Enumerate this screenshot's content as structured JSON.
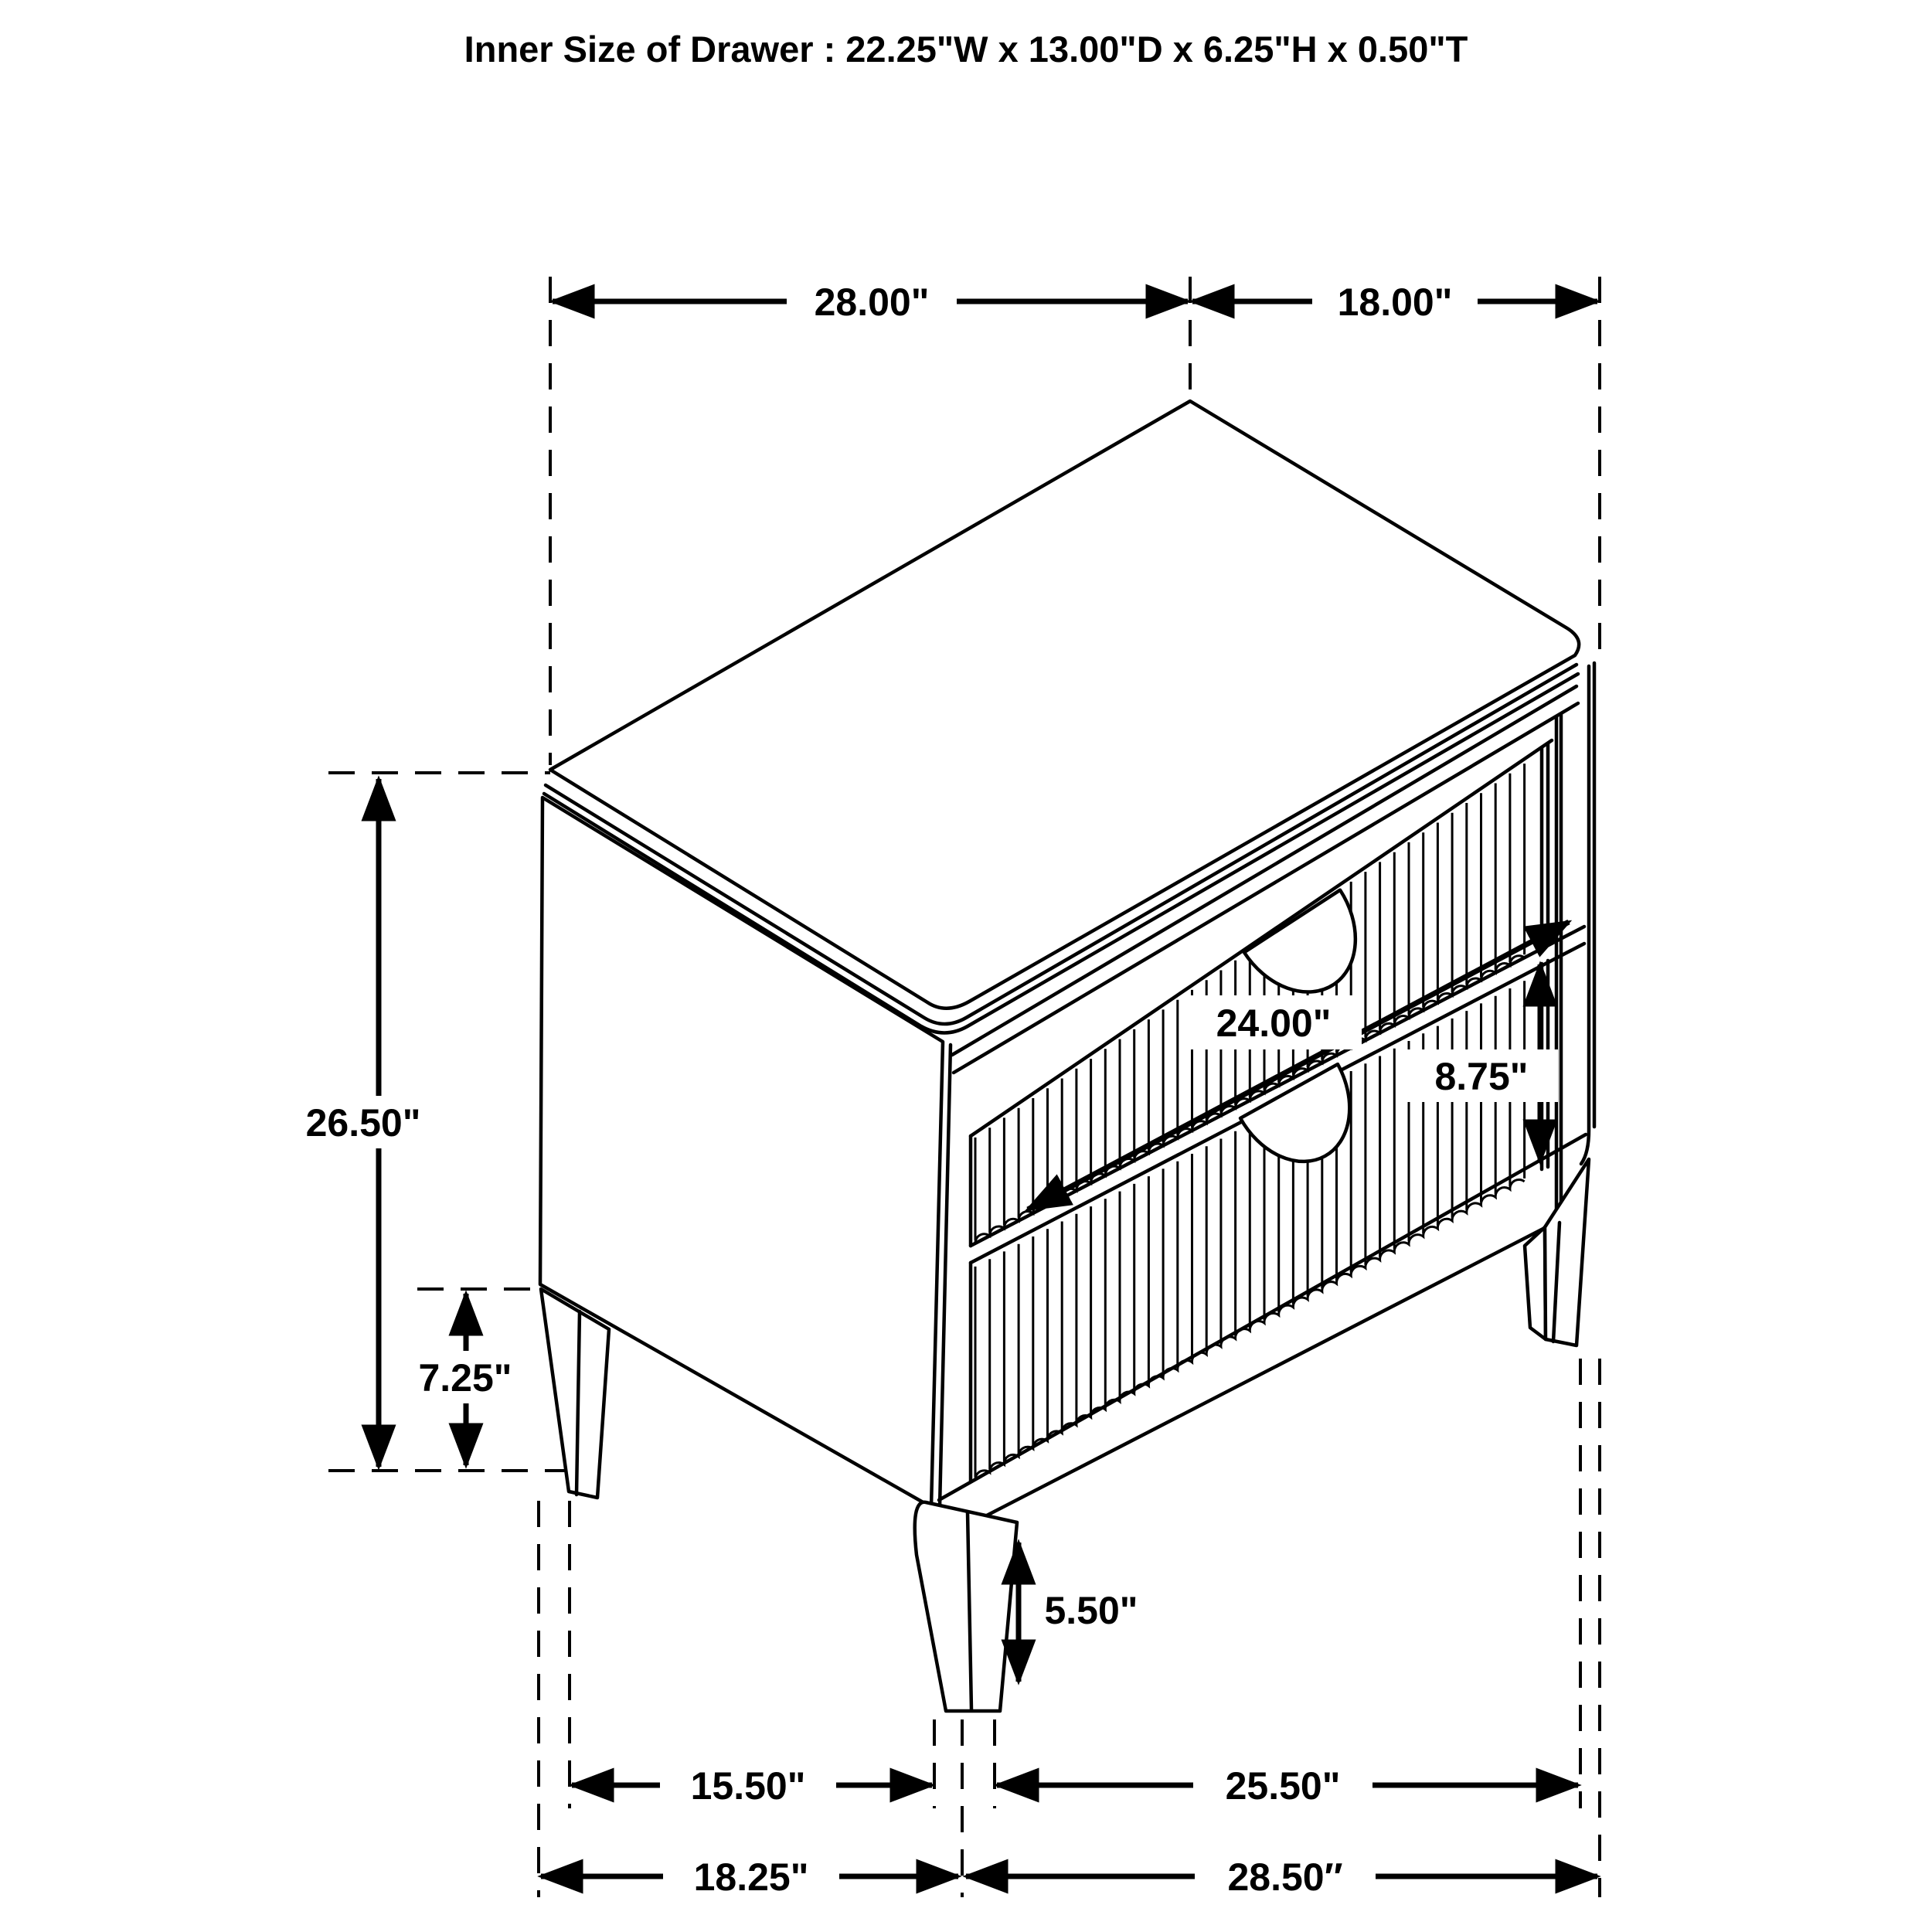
{
  "title": "Inner Size of Drawer : 22.25\"W x 13.00\"D x 6.25\"H x 0.50\"T",
  "dimensions": {
    "top_width": "28.00\"",
    "top_depth": "18.00\"",
    "overall_height": "26.50\"",
    "base_clearance": "7.25\"",
    "drawer_face_width": "24.00\"",
    "drawer_face_height": "8.75\"",
    "front_leg_height": "5.50\"",
    "leg_span_side": "15.50\"",
    "leg_span_front": "25.50\"",
    "footprint_depth": "18.25\"",
    "footprint_width": "28.50″"
  },
  "colors": {
    "line": "#000000",
    "background": "#ffffff"
  }
}
